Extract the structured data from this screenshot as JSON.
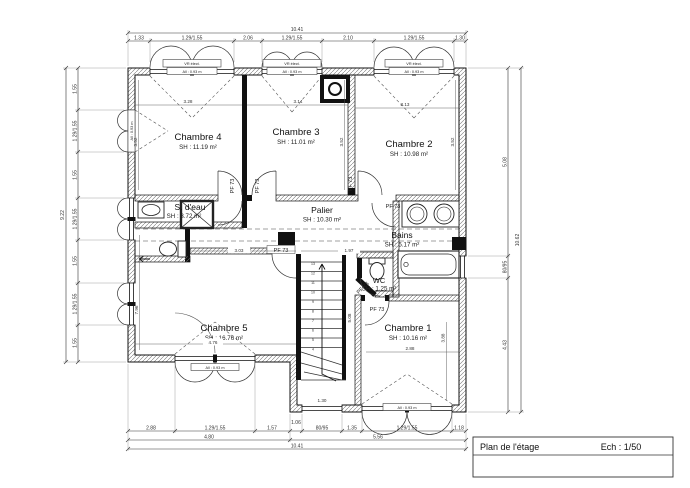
{
  "sheet": {
    "title": "Plan de l'étage",
    "scale_label": "Ech : 1/50"
  },
  "rooms": {
    "chambre4": {
      "name": "Chambre 4",
      "area": "SH : 11.19 m²"
    },
    "chambre3": {
      "name": "Chambre 3",
      "area": "SH : 11.01 m²"
    },
    "chambre2": {
      "name": "Chambre 2",
      "area": "SH : 10.98 m²"
    },
    "chambre5": {
      "name": "Chambre 5",
      "area": "SH : 16.76 m²"
    },
    "chambre1": {
      "name": "Chambre 1",
      "area": "SH : 10.16 m²"
    },
    "palier": {
      "name": "Palier",
      "area": "SH : 10.30 m²"
    },
    "bains": {
      "name": "Bains",
      "area": "SH : 5.17 m²"
    },
    "sdeau": {
      "name": "S. d'eau",
      "area": "SH : 3.72 m²"
    },
    "wc": {
      "name": "WC",
      "area": "SH : 1.25 m²"
    }
  },
  "doors": {
    "pf73": "PF 73"
  },
  "windows": {
    "shutter_label": "VR élect.",
    "sill_label": "All : 0.93 m"
  },
  "stairs": {
    "steps": [
      "13",
      "12",
      "11",
      "10",
      "9",
      "8",
      "7",
      "6",
      "5",
      "4"
    ]
  },
  "dims": {
    "top": {
      "total": "10.41",
      "segs": [
        "1.33",
        "1.29/1.55",
        "2.06",
        "1.29/1.55",
        "2.10",
        "1.29/1.55",
        "1.30"
      ]
    },
    "bottom": {
      "total": "10.41",
      "parts": [
        "4.80",
        "5.56"
      ],
      "segs": [
        "2.88",
        "1.29/1.55",
        "1.57",
        "1.06",
        "80/95",
        "1.35",
        "1.29/1.55",
        "1.18"
      ]
    },
    "left": {
      "total": "9.22",
      "segs": [
        "1.55",
        "1.29/1.55",
        "1.55",
        "1.29/1.55",
        "1.55",
        "1.29/1.55",
        "1.55"
      ]
    },
    "right": {
      "total": "10.62",
      "segs": [
        "5.08",
        "80/95",
        "4.43"
      ]
    },
    "interior": {
      "c4_w": "3.28",
      "c3_w": "3.14",
      "c2_w": "3.13",
      "c4_h": "3.52",
      "c3_h": "3.52",
      "c2_h": "3.52",
      "palier_w": "3.03",
      "hall_e": "1.97",
      "c5_w": "4.76",
      "c5_h": "7.96",
      "stair_h": "5.08",
      "c1_w": "2.88",
      "c1_h": "3.88",
      "ext_win": "1.30"
    }
  }
}
